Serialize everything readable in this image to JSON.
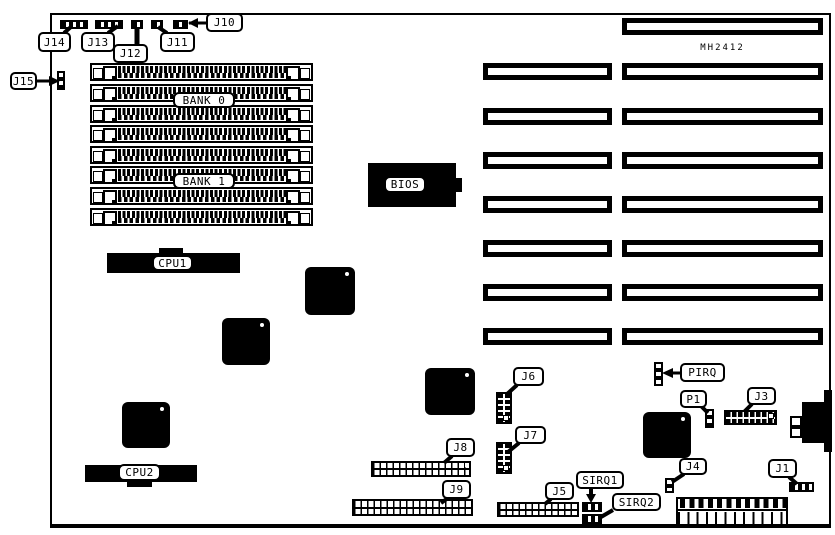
{
  "board": {
    "model": "MH2412",
    "ink_color": "#000000",
    "background_color": "#ffffff",
    "memory": {
      "bank0_label": "BANK 0",
      "bank1_label": "BANK 1",
      "simm_slot_count": 8
    },
    "chips": {
      "bios_label": "BIOS",
      "cpu1_label": "CPU1",
      "cpu2_label": "CPU2"
    },
    "expansion": {
      "long_slot_count": 8,
      "short_slot_count": 7
    },
    "callouts": {
      "j1": "J1",
      "j3": "J3",
      "j4": "J4",
      "j5": "J5",
      "j6": "J6",
      "j7": "J7",
      "j8": "J8",
      "j9": "J9",
      "j10": "J10",
      "j11": "J11",
      "j12": "J12",
      "j13": "J13",
      "j14": "J14",
      "j15": "J15",
      "p1": "P1",
      "pirq": "PIRQ",
      "sirq1": "SIRQ1",
      "sirq2": "SIRQ2"
    }
  }
}
